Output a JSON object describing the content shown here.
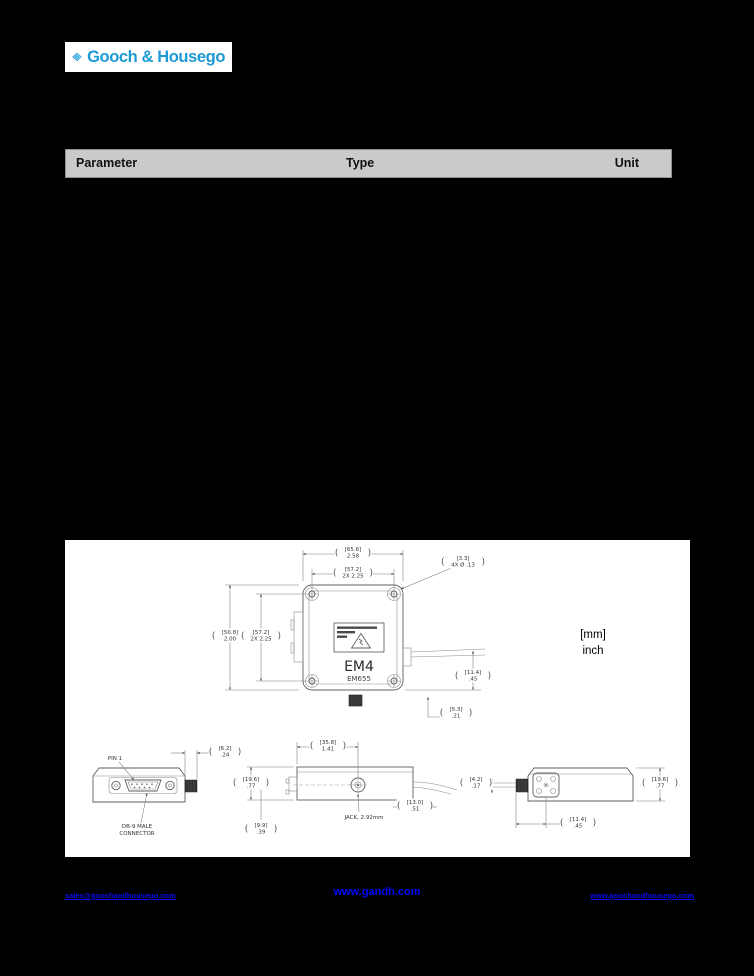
{
  "header": {
    "brand": "Gooch & Housego",
    "accent": "#1b9ad6"
  },
  "table": {
    "headers": {
      "parameter": "Parameter",
      "type": "Type",
      "unit": "Unit"
    }
  },
  "drawing": {
    "legend_mm": "[mm]",
    "legend_inch": "inch",
    "model": "EM4",
    "submodel": "EM655",
    "labels": {
      "pin1": "PIN 1",
      "db9_line1": "DB-9 MALE",
      "db9_line2": "CONNECTOR",
      "jack": "JACK, 2.92mm"
    },
    "dims": {
      "tv_width": {
        "mm": "[65.6]",
        "in": "2.58"
      },
      "tv_hole_h": {
        "mm": "[57.2]",
        "in": "2X 2.25"
      },
      "tv_hole_call": {
        "mm": "[3.3]",
        "in": "4X Ø .13"
      },
      "tv_height": {
        "mm": "[50.8]",
        "in": "2.00"
      },
      "tv_hole_v": {
        "mm": "[57.2]",
        "in": "2X 2.25"
      },
      "tv_fiber": {
        "mm": "[11.4]",
        "in": ".45"
      },
      "tv_bottom": {
        "mm": "[5.3]",
        "in": ".21"
      },
      "va_boot": {
        "mm": "[6.2]",
        "in": ".24"
      },
      "vb_jack_x": {
        "mm": "[35.8]",
        "in": "1.41"
      },
      "vb_height": {
        "mm": "[19.6]",
        "in": ".77"
      },
      "vb_bottom": {
        "mm": "[9.9]",
        "in": ".39"
      },
      "vb_right": {
        "mm": "[13.0]",
        "in": ".51"
      },
      "vc_left": {
        "mm": "[4.2]",
        "in": ".17"
      },
      "vc_height": {
        "mm": "[19.6]",
        "in": ".77"
      },
      "vc_bottom": {
        "mm": "[11.4]",
        "in": ".45"
      }
    }
  },
  "footer": {
    "email": "sales@goochandhousego.com",
    "site_center": "www.gandh.com",
    "site_right": "www.goochandhousego.com"
  }
}
